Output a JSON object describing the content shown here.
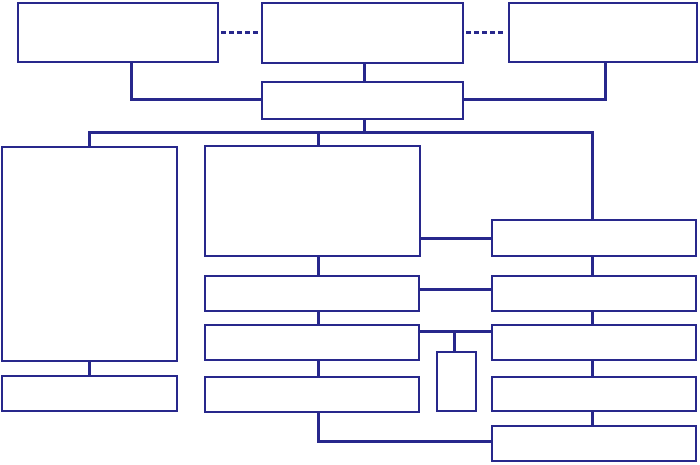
{
  "canvas": {
    "width": 700,
    "height": 465,
    "background_color": "#ffffff",
    "line_color": "#28288c",
    "box_fill_color": "#ffffff",
    "description": "Block diagram / flowchart of empty rectangular nodes connected by solid navy connector lines; two dashed links join the three top-level boxes."
  },
  "diagram": {
    "nodes": [
      {
        "id": "top-left-box",
        "x": 17,
        "y": 2,
        "w": 202,
        "h": 61
      },
      {
        "id": "top-center-box",
        "x": 261,
        "y": 2,
        "w": 203,
        "h": 62
      },
      {
        "id": "top-right-box",
        "x": 508,
        "y": 2,
        "w": 190,
        "h": 61
      },
      {
        "id": "hub-box",
        "x": 261,
        "y": 81,
        "w": 203,
        "h": 39
      },
      {
        "id": "left-tall-box",
        "x": 1,
        "y": 146,
        "w": 177,
        "h": 216
      },
      {
        "id": "left-bottom-box",
        "x": 1,
        "y": 375,
        "w": 177,
        "h": 37
      },
      {
        "id": "center-large-box",
        "x": 204,
        "y": 145,
        "w": 217,
        "h": 112
      },
      {
        "id": "center-box-2",
        "x": 204,
        "y": 275,
        "w": 216,
        "h": 37
      },
      {
        "id": "center-box-3",
        "x": 204,
        "y": 324,
        "w": 216,
        "h": 37
      },
      {
        "id": "center-box-4",
        "x": 204,
        "y": 376,
        "w": 216,
        "h": 37
      },
      {
        "id": "small-vertical-box",
        "x": 436,
        "y": 351,
        "w": 41,
        "h": 61
      },
      {
        "id": "right-box-1",
        "x": 491,
        "y": 219,
        "w": 206,
        "h": 38
      },
      {
        "id": "right-box-2",
        "x": 491,
        "y": 275,
        "w": 206,
        "h": 37
      },
      {
        "id": "right-box-3",
        "x": 491,
        "y": 324,
        "w": 206,
        "h": 37
      },
      {
        "id": "right-box-4",
        "x": 491,
        "y": 376,
        "w": 206,
        "h": 36
      },
      {
        "id": "right-box-5",
        "x": 491,
        "y": 425,
        "w": 206,
        "h": 37
      }
    ],
    "connectors": [
      {
        "id": "dashed-link-left",
        "type": "h",
        "x": 221,
        "y": 31,
        "len": 38,
        "dashed": true
      },
      {
        "id": "dashed-link-right",
        "type": "h",
        "x": 466,
        "y": 31,
        "len": 40,
        "dashed": true
      },
      {
        "id": "topleft-drop",
        "type": "v",
        "x": 130,
        "y": 63,
        "len": 38
      },
      {
        "id": "topleft-run",
        "type": "h",
        "x": 130,
        "y": 98,
        "len": 131
      },
      {
        "id": "topcenter-drop",
        "type": "v",
        "x": 363,
        "y": 64,
        "len": 18
      },
      {
        "id": "topright-drop",
        "type": "v",
        "x": 604,
        "y": 63,
        "len": 38
      },
      {
        "id": "topright-run",
        "type": "h",
        "x": 464,
        "y": 98,
        "len": 143
      },
      {
        "id": "hub-drop",
        "type": "v",
        "x": 363,
        "y": 120,
        "len": 14
      },
      {
        "id": "bus",
        "type": "h",
        "x": 88,
        "y": 131,
        "len": 506
      },
      {
        "id": "bus-left-riser",
        "type": "v",
        "x": 88,
        "y": 131,
        "len": 16
      },
      {
        "id": "bus-center-riser",
        "type": "v",
        "x": 317,
        "y": 131,
        "len": 15
      },
      {
        "id": "bus-right-riser",
        "type": "v",
        "x": 591,
        "y": 131,
        "len": 89
      },
      {
        "id": "left-column-link",
        "type": "v",
        "x": 88,
        "y": 362,
        "len": 14
      },
      {
        "id": "center-link-1",
        "type": "v",
        "x": 317,
        "y": 257,
        "len": 19
      },
      {
        "id": "center-link-2",
        "type": "v",
        "x": 317,
        "y": 312,
        "len": 13
      },
      {
        "id": "center-link-3",
        "type": "v",
        "x": 317,
        "y": 361,
        "len": 16
      },
      {
        "id": "bottom-drop",
        "type": "v",
        "x": 317,
        "y": 413,
        "len": 30
      },
      {
        "id": "bottom-run",
        "type": "h",
        "x": 317,
        "y": 440,
        "len": 175
      },
      {
        "id": "cross-link-1",
        "type": "h",
        "x": 421,
        "y": 237,
        "len": 70
      },
      {
        "id": "cross-link-2",
        "type": "h",
        "x": 420,
        "y": 288,
        "len": 71
      },
      {
        "id": "cross-link-3",
        "type": "h",
        "x": 420,
        "y": 330,
        "len": 71
      },
      {
        "id": "small-box-stem",
        "type": "v",
        "x": 453,
        "y": 330,
        "len": 22
      },
      {
        "id": "right-link-1",
        "type": "v",
        "x": 591,
        "y": 257,
        "len": 19
      },
      {
        "id": "right-link-2",
        "type": "v",
        "x": 591,
        "y": 312,
        "len": 13
      },
      {
        "id": "right-link-3",
        "type": "v",
        "x": 591,
        "y": 361,
        "len": 16
      },
      {
        "id": "right-link-4",
        "type": "v",
        "x": 591,
        "y": 412,
        "len": 14
      }
    ]
  }
}
